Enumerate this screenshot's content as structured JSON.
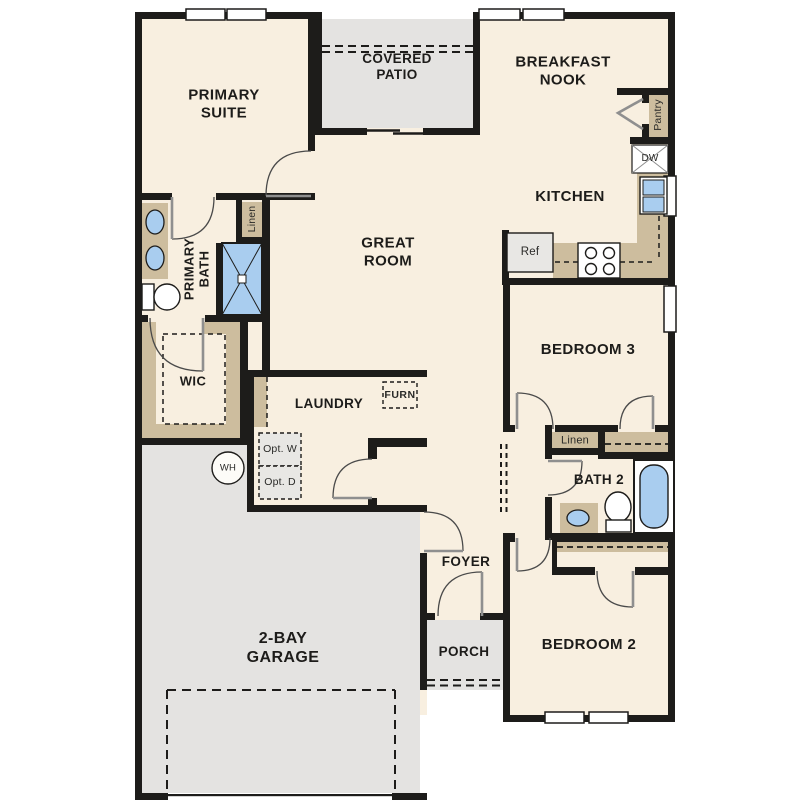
{
  "plan": {
    "rooms": {
      "primary_suite": "PRIMARY SUITE",
      "covered_patio": "COVERED PATIO",
      "breakfast_nook": "BREAKFAST NOOK",
      "kitchen": "KITCHEN",
      "great_room": "GREAT ROOM",
      "primary_bath": "PRIMARY BATH",
      "wic": "WIC",
      "laundry": "LAUNDRY",
      "bedroom3": "BEDROOM 3",
      "bath2": "BATH 2",
      "bedroom2": "BEDROOM 2",
      "foyer": "FOYER",
      "porch": "PORCH",
      "garage": "2-BAY GARAGE"
    },
    "labels": {
      "linen_primary": "Linen",
      "linen_hall": "Linen",
      "pantry": "Pantry",
      "dishwasher": "DW",
      "refrigerator": "Ref",
      "furnace": "FURN",
      "water_heater": "WH",
      "opt_washer": "Opt. W",
      "opt_dryer": "Opt. D"
    },
    "colors": {
      "wall": "#1d1c1a",
      "floor": "#f8efe0",
      "outdoor": "#e4e3e1",
      "casework": "#cdbd9e",
      "fixture_blue": "#a9cdef",
      "appliance_grey": "#e8e7e4",
      "door_line": "#8f8f8f",
      "arc_line": "#4a4a4a"
    }
  }
}
